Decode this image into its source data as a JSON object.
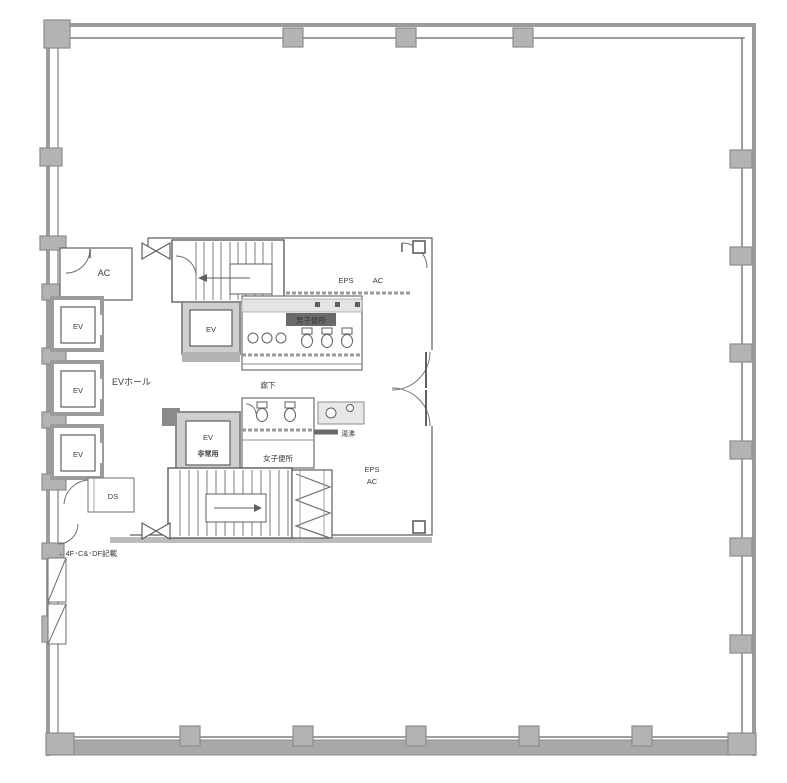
{
  "plan": {
    "labels": {
      "ac_room": "AC",
      "ev": "EV",
      "ev_hall": "EVホール",
      "eps_top": "EPS",
      "ac_top": "AC",
      "mens_toilet": "男子便所",
      "corridor": "廊下",
      "womens_toilet": "女子便所",
      "hot_water": "湯沸",
      "service_ev_use": "非常用",
      "eps_bottom": "EPS",
      "ac_bottom": "AC",
      "ds": "DS",
      "note": "←4F･C&･DF記載"
    },
    "colors": {
      "wall": "#9c9c9c",
      "column": "#b3b3b3",
      "line": "#5f5f5f",
      "light_fill": "#e4e4e4",
      "shaft_fill": "#cfcfcf",
      "text": "#3a3a3a"
    }
  }
}
